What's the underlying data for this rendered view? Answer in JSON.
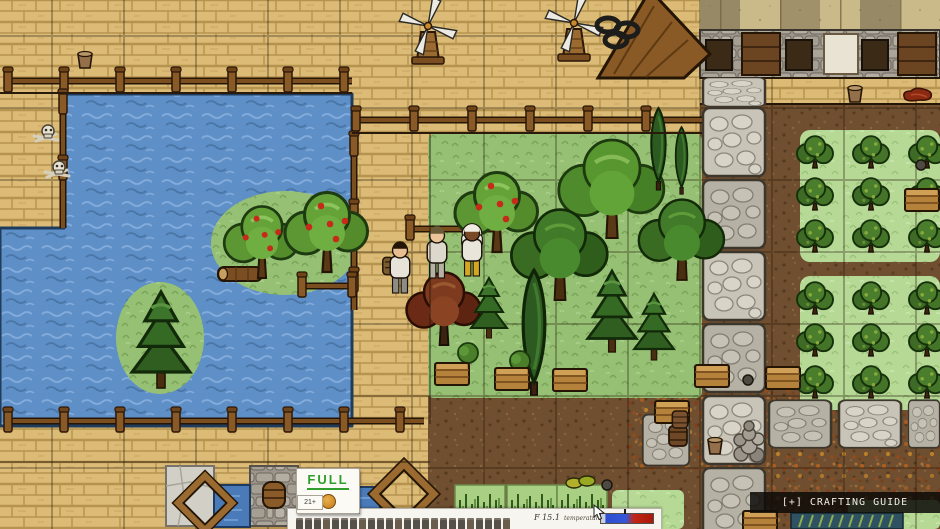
{
  "hud": {
    "full_sign": "FULL",
    "food_bonus": "21+",
    "food_meter_label": "FOOD METER +21",
    "food_pips": 24,
    "fps": "F 15.1",
    "temperature_label": "temperature",
    "temperature_fraction": 0.45
  },
  "overlay": {
    "crafting_guide": "[+] CRAFTING GUIDE"
  },
  "palette": {
    "water": "#5e8fc6",
    "grass": "#96c175",
    "grass_light": "#b6d996",
    "dirt": "#6f4f30",
    "wood_floor": "#dcbb76",
    "cobble": "#c8c4b8",
    "full_green": "#2f9e2c",
    "temp_cold": "#2b4fd0",
    "temp_hot": "#c22718",
    "ui_paper": "#f7f5ef",
    "overlay_bar": "#0d0b08"
  },
  "world": {
    "objects": [
      {
        "t": "barn-roof",
        "x": 654,
        "y": 34
      },
      {
        "t": "windmill",
        "x": 428,
        "y": 30
      },
      {
        "t": "windmill",
        "x": 574,
        "y": 27
      },
      {
        "t": "dark-rings",
        "x": 617,
        "y": 32
      },
      {
        "t": "bucket",
        "x": 85,
        "y": 66
      },
      {
        "t": "bone-pile",
        "x": 46,
        "y": 134
      },
      {
        "t": "bone-pile",
        "x": 57,
        "y": 170
      },
      {
        "t": "log",
        "x": 240,
        "y": 274
      },
      {
        "t": "apple-tree",
        "x": 262,
        "y": 278,
        "s": 1.35
      },
      {
        "t": "apple-tree",
        "x": 327,
        "y": 272,
        "s": 1.5
      },
      {
        "t": "pine-tree",
        "x": 161,
        "y": 388,
        "s": 1.6
      },
      {
        "t": "apple-tree",
        "x": 497,
        "y": 252,
        "s": 1.5
      },
      {
        "t": "oak-tree",
        "x": 612,
        "y": 238,
        "s": 1.4
      },
      {
        "t": "cypress-pair",
        "x": 670,
        "y": 190,
        "s": 1.05
      },
      {
        "t": "dark-oak-tree",
        "x": 560,
        "y": 300,
        "s": 1.35
      },
      {
        "t": "dark-oak-tree",
        "x": 682,
        "y": 280,
        "s": 1.2
      },
      {
        "t": "pine-tree",
        "x": 612,
        "y": 352,
        "s": 1.35
      },
      {
        "t": "cypress-tree",
        "x": 534,
        "y": 395,
        "s": 1.6
      },
      {
        "t": "maple-tree",
        "x": 444,
        "y": 345,
        "s": 1.25
      },
      {
        "t": "pine-tree",
        "x": 489,
        "y": 338,
        "s": 1.0
      },
      {
        "t": "pine-tree",
        "x": 654,
        "y": 360,
        "s": 1.1
      },
      {
        "t": "small-bush",
        "x": 468,
        "y": 362
      },
      {
        "t": "small-bush",
        "x": 520,
        "y": 370
      },
      {
        "t": "crate",
        "x": 452,
        "y": 374
      },
      {
        "t": "crate",
        "x": 512,
        "y": 379
      },
      {
        "t": "crate",
        "x": 570,
        "y": 380
      },
      {
        "t": "crate",
        "x": 712,
        "y": 376
      },
      {
        "t": "crate",
        "x": 783,
        "y": 378
      },
      {
        "t": "crate",
        "x": 672,
        "y": 412
      },
      {
        "t": "crate",
        "x": 922,
        "y": 200
      },
      {
        "t": "round-item",
        "x": 921,
        "y": 165
      },
      {
        "t": "round-item",
        "x": 748,
        "y": 380
      },
      {
        "t": "barrel-stack",
        "x": 679,
        "y": 446
      },
      {
        "t": "bucket",
        "x": 715,
        "y": 452
      },
      {
        "t": "stone-well",
        "x": 749,
        "y": 448
      },
      {
        "t": "bucket",
        "x": 855,
        "y": 100
      },
      {
        "t": "meat",
        "x": 919,
        "y": 97
      },
      {
        "t": "crate",
        "x": 760,
        "y": 522
      },
      {
        "t": "reeds",
        "x": 847,
        "y": 521
      },
      {
        "t": "squash",
        "x": 580,
        "y": 483
      },
      {
        "t": "round-item",
        "x": 607,
        "y": 485
      },
      {
        "t": "white-tile",
        "x": 190,
        "y": 496
      },
      {
        "t": "hatch-wall",
        "x": 274,
        "y": 496
      },
      {
        "t": "blue-tile",
        "x": 232,
        "y": 506
      },
      {
        "t": "blue-tile",
        "x": 362,
        "y": 508
      },
      {
        "t": "frame-kit",
        "x": 205,
        "y": 503,
        "s": 0.95
      },
      {
        "t": "frame-kit",
        "x": 404,
        "y": 494,
        "s": 1.05
      }
    ],
    "fences": [
      {
        "dir": "h",
        "x": 4,
        "y": 92,
        "len": 348,
        "step": 56
      },
      {
        "dir": "h",
        "x": 352,
        "y": 131,
        "len": 350,
        "step": 58
      },
      {
        "dir": "v",
        "x": 354,
        "y": 138,
        "len": 172,
        "step": 68
      },
      {
        "dir": "h",
        "x": 4,
        "y": 432,
        "len": 420,
        "step": 56
      },
      {
        "dir": "h",
        "x": 298,
        "y": 297,
        "len": 58,
        "step": 50
      },
      {
        "dir": "v",
        "x": 63,
        "y": 96,
        "len": 132,
        "step": 66
      },
      {
        "dir": "h",
        "x": 406,
        "y": 240,
        "len": 92,
        "step": 60
      }
    ],
    "road": {
      "column_x": 734,
      "column_cells": [
        [
          92,
          0.42,
          "a"
        ],
        [
          142,
          1,
          "a"
        ],
        [
          214,
          1,
          "b"
        ],
        [
          286,
          1,
          "a"
        ],
        [
          358,
          1,
          "b"
        ],
        [
          430,
          1,
          "a"
        ],
        [
          502,
          1,
          "b"
        ]
      ],
      "branch_cells": [
        {
          "x": 800,
          "y": 424,
          "v": "b",
          "sy": 0.7
        },
        {
          "x": 870,
          "y": 424,
          "v": "a",
          "sy": 0.7
        },
        {
          "x": 924,
          "y": 424,
          "v": "b",
          "sx": 0.5,
          "sy": 0.7
        },
        {
          "x": 666,
          "y": 440,
          "v": "b",
          "sx": 0.75,
          "sy": 0.75
        }
      ]
    },
    "berry_plots": [
      {
        "x": 815,
        "y": 154,
        "cols": 3,
        "rows": 3,
        "dx": 56,
        "dy": 42
      },
      {
        "x": 815,
        "y": 300,
        "cols": 3,
        "rows": 3,
        "dx": 56,
        "dy": 42
      }
    ],
    "sprout_tiles": [
      [
        480,
        508
      ],
      [
        532,
        508
      ],
      [
        582,
        508
      ]
    ],
    "characters": [
      {
        "x": 400,
        "y": 293,
        "skin": "#e8bd92",
        "hair": "#241408",
        "top": "#e7e3d8",
        "bottom": "#8d8d88",
        "acc": "backpack"
      },
      {
        "x": 437,
        "y": 278,
        "skin": "#ecc49a",
        "hair": "#6a5a38",
        "top": "#dcd8cc",
        "bottom": "#b8b2a4",
        "acc": null
      },
      {
        "x": 472,
        "y": 276,
        "skin": "#7a4a28",
        "hair": "#f0ece2",
        "top": "#e9e5da",
        "bottom": "#d4a81e",
        "acc": "hood"
      }
    ]
  }
}
